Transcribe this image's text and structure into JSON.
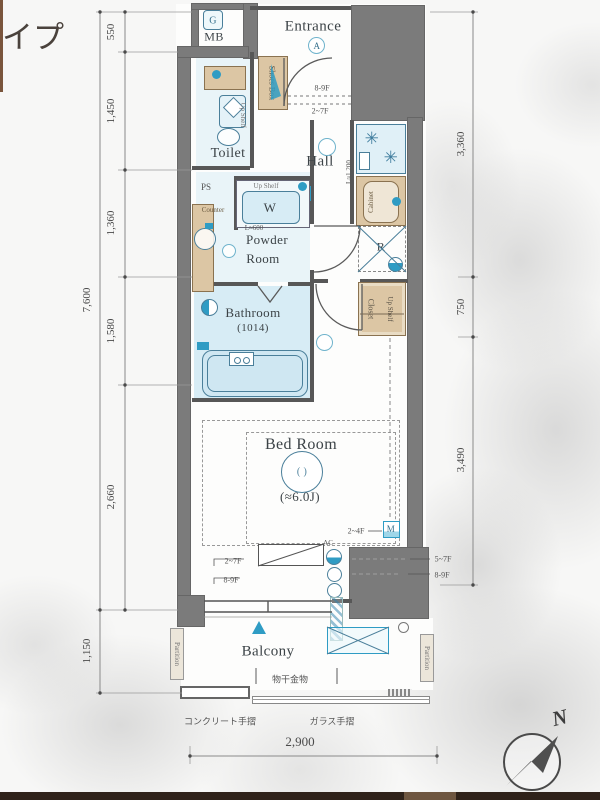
{
  "header": {
    "title_fragment": "イプ"
  },
  "plan": {
    "mb": {
      "meter": "G",
      "label": "MB"
    },
    "entrance": {
      "label": "Entrance",
      "light": "A",
      "step_upper": "8-9F",
      "step_lower": "2~7F",
      "shoes_box": "Shoes Box"
    },
    "toilet": {
      "label": "Toilet",
      "shelf": "Up Shelf"
    },
    "hall": {
      "label": "Hall",
      "remote": "R"
    },
    "powder": {
      "line1": "Powder",
      "line2": "Room",
      "counter": "Counter",
      "ps": "PS"
    },
    "laundry": {
      "shelf": "Up Shelf",
      "symbol": "W",
      "width": "L≈600"
    },
    "kitchen": {
      "length": "L≈1,200",
      "cabinet": "Cabinet",
      "fridge": "R"
    },
    "closet": {
      "label": "Closet",
      "shelf": "Up Shelf"
    },
    "bathroom": {
      "label": "Bathroom",
      "size": "(1014)"
    },
    "bedroom": {
      "label": "Bed Room",
      "size": "(≈6.0J)",
      "light_mark": "( )",
      "ac": "AC",
      "meter": "M",
      "floors_meter": "2~4F",
      "floors_wall_a": "5~7F",
      "floors_wall_b": "8-9F",
      "floors_win_a": "2~7F",
      "floors_win_b": "8-9F"
    },
    "balcony": {
      "label": "Balcony",
      "partition": "Partition",
      "laundry_fitting": "物干金物"
    }
  },
  "dimensions": {
    "left_segments": [
      "550",
      "1,450",
      "1,360",
      "1,580",
      "2,660"
    ],
    "left_total": "7,600",
    "left_balcony": "1,150",
    "right_segments": [
      "3,360",
      "750",
      "3,490"
    ],
    "bottom_width": "2,900",
    "rail_concrete": "コンクリート手摺",
    "rail_glass": "ガラス手摺"
  },
  "compass": {
    "north": "N"
  },
  "icons": {
    "burner": "✳"
  },
  "colors": {
    "wall": "#7b7b7b",
    "accent_blue": "#2f9cc4",
    "fixture_fill": "#d7ecf5",
    "wood": "#dcc6a4"
  }
}
